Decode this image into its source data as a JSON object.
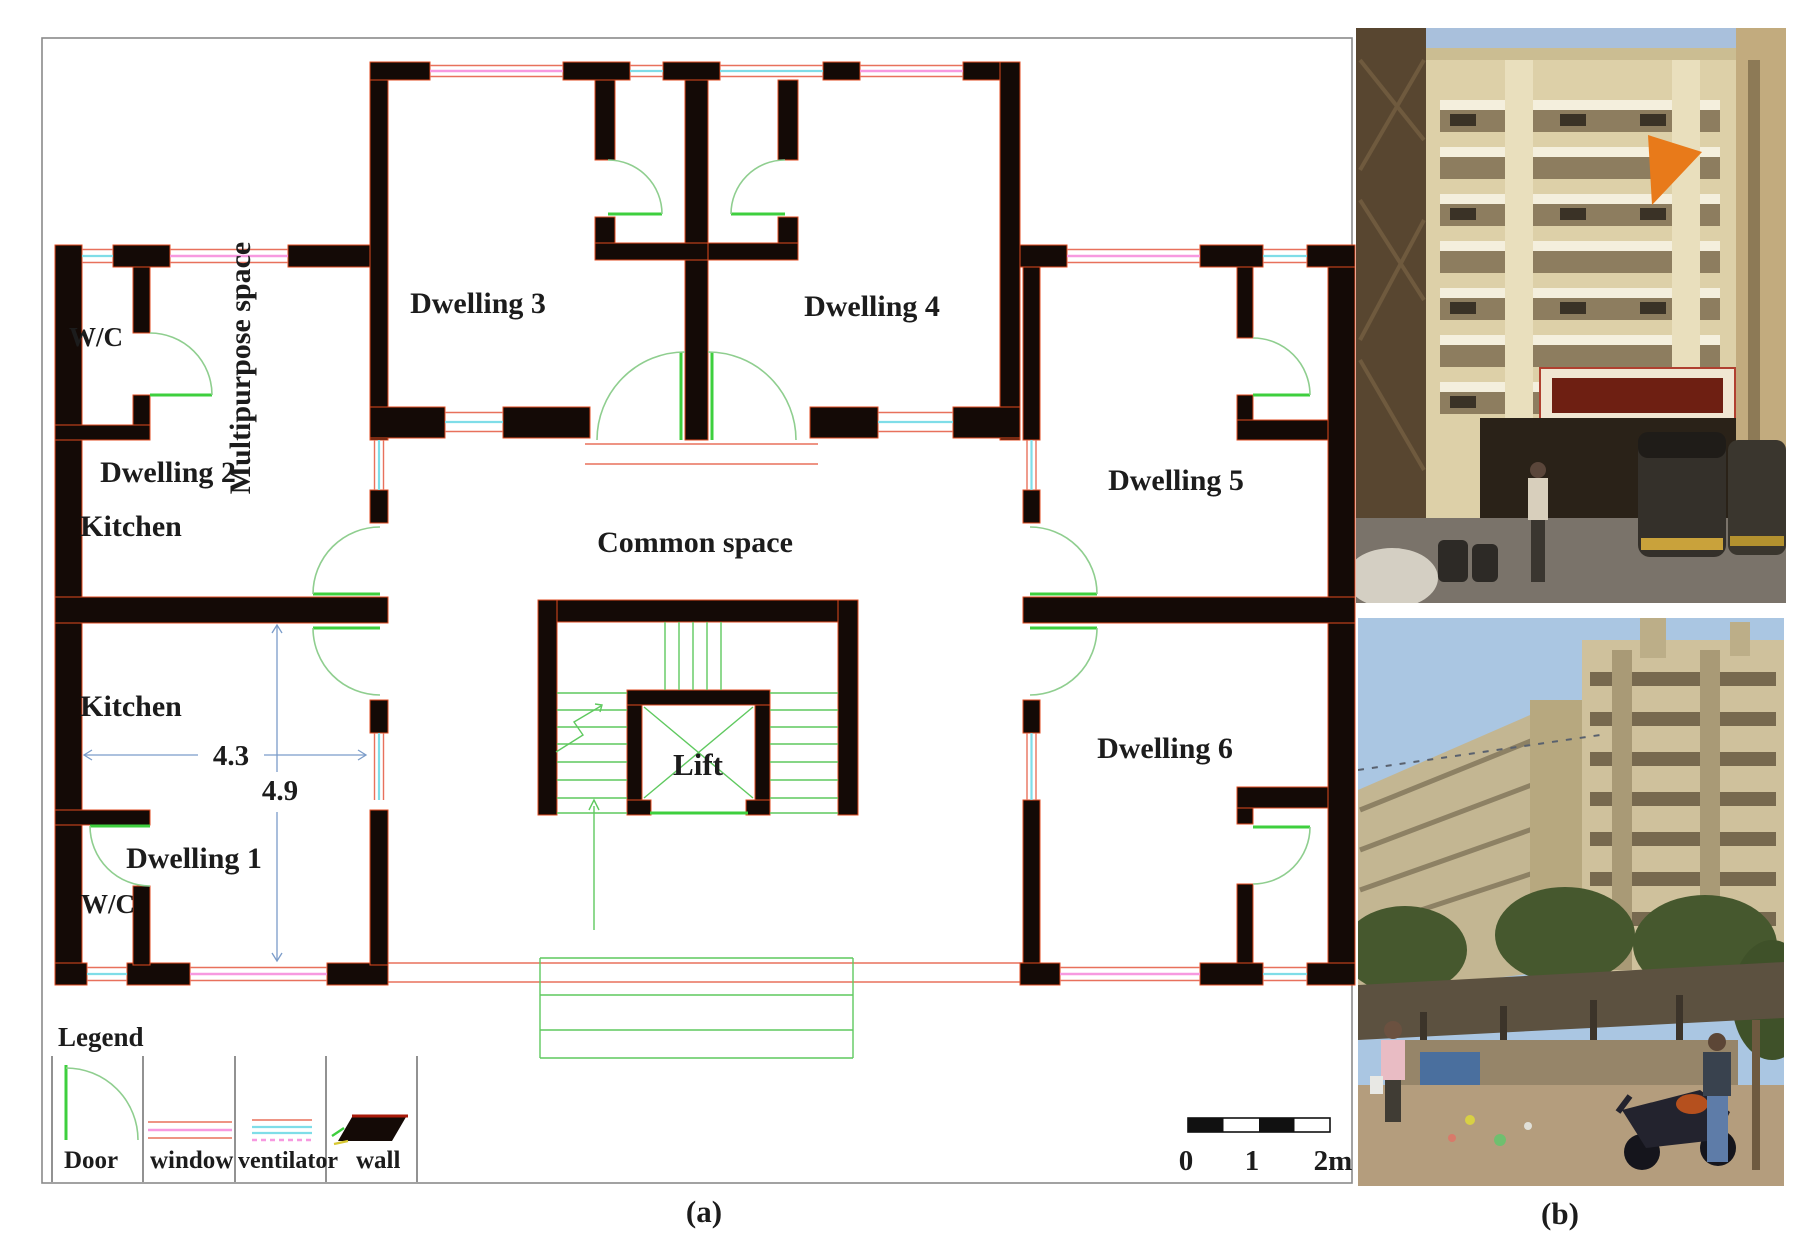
{
  "plan": {
    "rooms": {
      "wc_top": "W/C",
      "dwelling2": "Dwelling 2",
      "kitchen_d2": "Kitchen",
      "multipurpose": "Multipurpose space",
      "dwelling3": "Dwelling 3",
      "dwelling4": "Dwelling 4",
      "dwelling5": "Dwelling 5",
      "common": "Common space",
      "kitchen_d1": "Kitchen",
      "dwelling1": "Dwelling 1",
      "wc_bottom": "W/C",
      "dwelling6": "Dwelling 6",
      "lift": "Lift"
    },
    "dimensions": {
      "kitchen_width_m": "4.3",
      "kitchen_height_m": "4.9"
    },
    "legend": {
      "title": "Legend",
      "door": "Door",
      "window": "window",
      "ventilator": "ventilator",
      "wall": "wall"
    },
    "scale_bar": {
      "tick0": "0",
      "tick1": "1",
      "tick2": "2m"
    }
  },
  "captions": {
    "a": "(a)",
    "b": "(b)"
  },
  "colors": {
    "wall": "#140a06",
    "wallEdge": "#e04a1f",
    "winPink": "#f799e0",
    "winRed": "#e8715c",
    "ventCyan": "#7fdde8",
    "doorArc": "#8fce8f",
    "doorLeaf": "#3ecf3e",
    "stair": "#5fc95f",
    "dim": "#7b9cc9",
    "ink": "#1c1c1c"
  }
}
